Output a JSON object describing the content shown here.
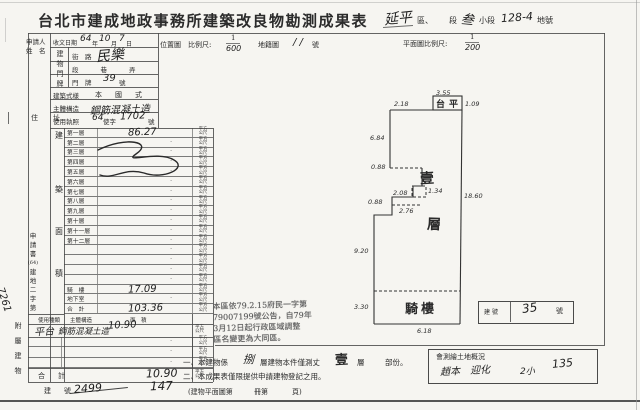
{
  "title": "台北市建成地政事務所建築改良物勘測成果表",
  "header": {
    "district": "延平",
    "district_suffix": "區、",
    "section_label": "段",
    "subsection": "叁",
    "subsection_label": "小段",
    "parcel": "128-4",
    "parcel_label": "地號"
  },
  "applicant": {
    "line1": "申請人",
    "line2": "姓　名"
  },
  "received": {
    "label": "收文日期",
    "year": "64",
    "year_label": "年",
    "month": "10",
    "month_label": "月",
    "day": "7",
    "day_label": "日"
  },
  "maps": {
    "location_label": "位置圖",
    "scale_label": "比例尺:",
    "scale_num": "1",
    "scale_den": "600",
    "cadastral_label": "地籍圖",
    "cadastral_value": "/ /",
    "cadastral_suffix": "號",
    "plan_scale_label": "平面圖比例尺:",
    "plan_scale_num": "1",
    "plan_scale_den": "200"
  },
  "door": {
    "col_chars": [
      "建",
      "物",
      "門",
      "牌"
    ],
    "street_label": "街　路",
    "street_value": "民樂",
    "lane_row": "段　　巷　　弄",
    "door_label": "門　牌",
    "door_value": "39",
    "door_suffix": "號"
  },
  "building": {
    "style_label": "建築式樣",
    "style_value": "本　國　式",
    "structure_label": "主體構造",
    "structure_value": "鋼筋混凝土造",
    "license_label": "使用執照",
    "license_year": "64",
    "license_mid": "使字",
    "license_no": "1702",
    "license_suffix": "號"
  },
  "address_label": "住　址",
  "area_label_chars": [
    "建",
    "築",
    "面",
    "積"
  ],
  "unit_top": "平方",
  "unit_bottom": "公尺",
  "floors": [
    {
      "label": "第一層",
      "value": "86.27"
    },
    {
      "label": "第二層",
      "value": ""
    },
    {
      "label": "第三層",
      "value": ""
    },
    {
      "label": "第四層",
      "value": ""
    },
    {
      "label": "第五層",
      "value": ""
    },
    {
      "label": "第六層",
      "value": ""
    },
    {
      "label": "第七層",
      "value": ""
    },
    {
      "label": "第八層",
      "value": ""
    },
    {
      "label": "第九層",
      "value": ""
    },
    {
      "label": "第十層",
      "value": ""
    },
    {
      "label": "第十一層",
      "value": ""
    },
    {
      "label": "第十二層",
      "value": ""
    },
    {
      "label": "",
      "value": ""
    },
    {
      "label": "",
      "value": ""
    },
    {
      "label": "",
      "value": ""
    },
    {
      "label": "",
      "value": ""
    },
    {
      "label": "騎　樓",
      "value": "17.09"
    },
    {
      "label": "地下室",
      "value": ""
    },
    {
      "label": "合　計",
      "value": "103.36"
    }
  ],
  "application_no": {
    "chars": [
      "申",
      "請",
      "書",
      "(64)",
      "建",
      "地",
      "二",
      "字",
      "第"
    ],
    "value": "7261"
  },
  "annex": {
    "label_chars": [
      "附",
      "屬",
      "建",
      "物"
    ],
    "header_use": "使用種類",
    "header_structure": "主體構造",
    "header_area": "面　積",
    "use_value": "平台",
    "structure_value": "鋼筋混凝土造",
    "area_value": "10.90",
    "total_label": "合　計",
    "total_value": "10.90"
  },
  "building_no": {
    "label": "建　號",
    "crossed": "2499",
    "value": "147",
    "plan_ref_1": "(建物平面圖第",
    "plan_ref_2": "冊第",
    "plan_ref_3": "頁)"
  },
  "stamp_note": {
    "line1": "本區依79.2.15府民一字第",
    "line2": "79007199號公告，自79年",
    "line3": "3月12日起行政區域調整",
    "line4": "區名變更為大同區。"
  },
  "notes": {
    "n1_prefix": "一、本建物係",
    "n1_hand": "捌",
    "n1_mid": "層建物本件僅測丈",
    "n1_stamp": "壹",
    "n1_unit": "層",
    "n1_tail": "部份。",
    "n2": "二、本成果表僅限提供申請建物登記之用。"
  },
  "surveyor": {
    "label": "會測繪土地概況",
    "hand_name": "趙本　迎化",
    "hand_a": "2小",
    "hand_b": "135"
  },
  "plan": {
    "dims": [
      "2.18",
      "3.55",
      "1.09",
      "6.84",
      "0.88",
      "2.08",
      "1.34",
      "2.76",
      "0.88",
      "9.20",
      "3.30",
      "6.18",
      "18.60"
    ],
    "stamps": {
      "balcony": "台平",
      "floor_a": "壹",
      "floor_b": "層",
      "arcade": "騎樓"
    },
    "no_box": {
      "label": "建號",
      "value": "35",
      "suffix": "號"
    }
  }
}
